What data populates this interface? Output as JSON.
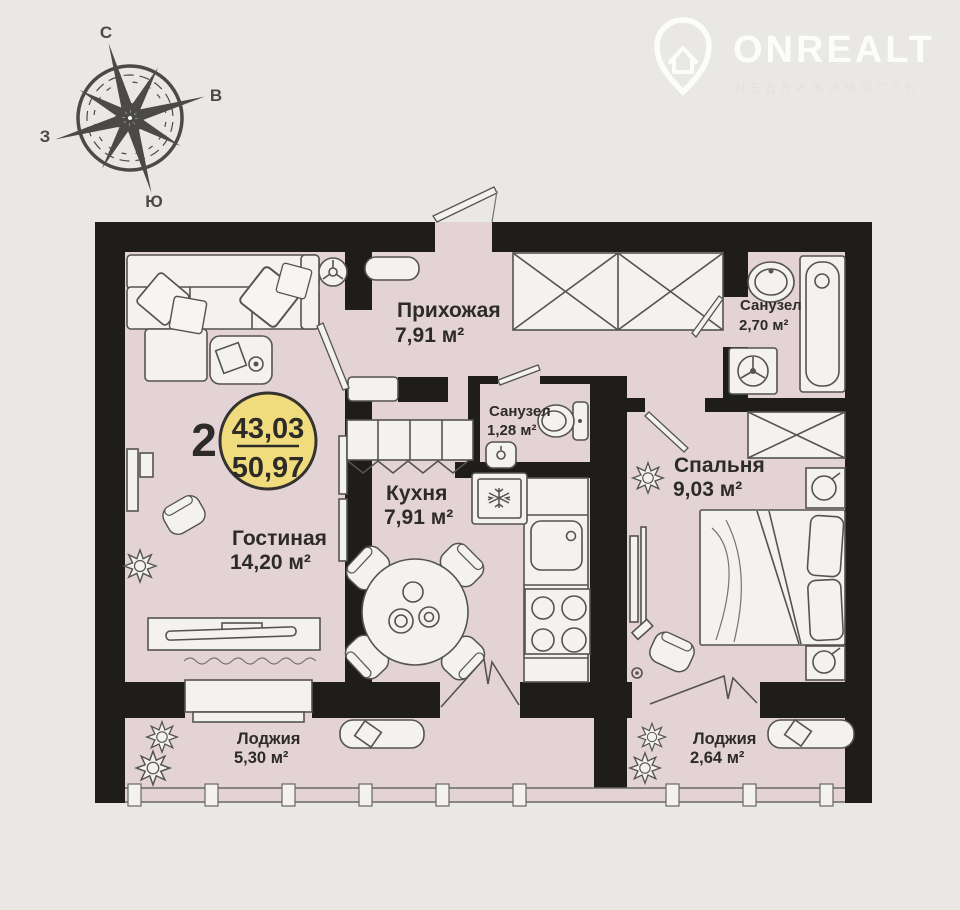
{
  "brand": {
    "name": "ONREALT",
    "tagline": "НЕДВИЖИМОСТЬ"
  },
  "compass": {
    "north": "С",
    "east": "В",
    "south": "Ю",
    "west": "З"
  },
  "unit_badge": {
    "rooms_count": "2",
    "living_area": "43,03",
    "total_area": "50,97"
  },
  "rooms": [
    {
      "name": "Прихожая",
      "area": "7,91 м²"
    },
    {
      "name": "Санузел",
      "area": "2,70 м²"
    },
    {
      "name": "Санузел",
      "area": "1,28 м²"
    },
    {
      "name": "Спальня",
      "area": "9,03 м²"
    },
    {
      "name": "Кухня",
      "area": "7,91 м²"
    },
    {
      "name": "Гостиная",
      "area": "14,20 м²"
    },
    {
      "name": "Лоджия",
      "area": "5,30 м²"
    },
    {
      "name": "Лоджия",
      "area": "2,64 м²"
    }
  ],
  "colors": {
    "background": "#e9e8e5",
    "floor": "#e3d3d6",
    "walls": "#1e1d1b",
    "badge": "#f1dc7d"
  }
}
